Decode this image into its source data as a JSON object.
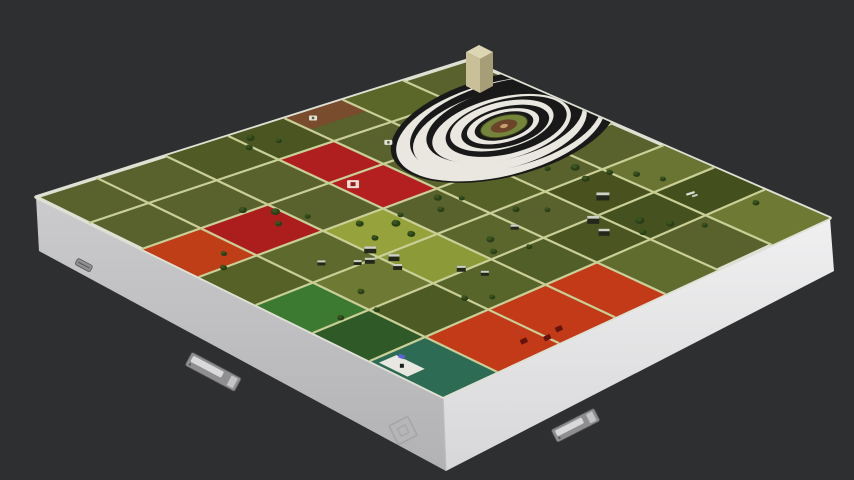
{
  "scene": {
    "background": "#2e2f30",
    "board": {
      "corners": {
        "west": [
          36,
          197
        ],
        "north": [
          468,
          60
        ],
        "east": [
          830,
          218
        ],
        "south": [
          443,
          397
        ]
      },
      "base_color": "#59612c",
      "rim_color": "#dfe0d4",
      "road_color": "#c9cf96",
      "tree_dark": "#2a3f18",
      "tree_light": "#3a541f",
      "building_body": "#23281a",
      "building_roof": "#cfd0c6",
      "u_roads": [
        0.14,
        0.3,
        0.445,
        0.575,
        0.71,
        0.85
      ],
      "v_roads": [
        0.13,
        0.26,
        0.4,
        0.54,
        0.68,
        0.82
      ],
      "parcels": [
        {
          "name": "brown-plot",
          "u": [
            0.575,
            0.71
          ],
          "v": [
            0,
            0.065
          ],
          "color": "#7a4c2e"
        },
        {
          "name": "nw-row-a",
          "u": [
            0.3,
            0.445
          ],
          "v": [
            0,
            0.13
          ],
          "color": "#4f5a24"
        },
        {
          "name": "nw-row-b",
          "u": [
            0.445,
            0.575
          ],
          "v": [
            0,
            0.13
          ],
          "color": "#4a5521"
        },
        {
          "name": "red-upper-a",
          "u": [
            0.445,
            0.575
          ],
          "v": [
            0.13,
            0.26
          ],
          "color": "#b01f1f"
        },
        {
          "name": "red-upper-b",
          "u": [
            0.445,
            0.575
          ],
          "v": [
            0.26,
            0.4
          ],
          "color": "#b3201f"
        },
        {
          "name": "red-left",
          "u": [
            0.14,
            0.3
          ],
          "v": [
            0.26,
            0.4
          ],
          "color": "#ac1e1e"
        },
        {
          "name": "orange-left",
          "u": [
            0,
            0.14
          ],
          "v": [
            0.26,
            0.4
          ],
          "color": "#bf3d17"
        },
        {
          "name": "olive-mid-a",
          "u": [
            0.14,
            0.3
          ],
          "v": [
            0.4,
            0.54
          ],
          "color": "#5e6a2d"
        },
        {
          "name": "lime-a",
          "u": [
            0.3,
            0.445
          ],
          "v": [
            0.4,
            0.54
          ],
          "color": "#96a23c"
        },
        {
          "name": "lime-b",
          "u": [
            0.3,
            0.445
          ],
          "v": [
            0.54,
            0.68
          ],
          "color": "#8c9a38"
        },
        {
          "name": "olive-left-a",
          "u": [
            0,
            0.14
          ],
          "v": [
            0.4,
            0.54
          ],
          "color": "#556127"
        },
        {
          "name": "green-bright",
          "u": [
            0,
            0.14
          ],
          "v": [
            0.54,
            0.68
          ],
          "color": "#3c7a31"
        },
        {
          "name": "green-deep",
          "u": [
            0,
            0.14
          ],
          "v": [
            0.68,
            0.82
          ],
          "color": "#2f5a27"
        },
        {
          "name": "teal-plot",
          "u": [
            0,
            0.14
          ],
          "v": [
            0.82,
            1
          ],
          "color": "#2e6b55"
        },
        {
          "name": "orange-big",
          "u": [
            0.14,
            0.575
          ],
          "v": [
            0.82,
            1
          ],
          "color": "#c23a17"
        },
        {
          "name": "olive-dark-a",
          "u": [
            0.71,
            0.85
          ],
          "v": [
            0.54,
            0.68
          ],
          "color": "#49511f"
        },
        {
          "name": "olive-dark-b",
          "u": [
            0.85,
            1
          ],
          "v": [
            0.68,
            0.82
          ],
          "color": "#43501d"
        },
        {
          "name": "olive-dark-c",
          "u": [
            0.575,
            0.71
          ],
          "v": [
            0.68,
            0.82
          ],
          "color": "#4a5522"
        },
        {
          "name": "olive-light-a",
          "u": [
            0.85,
            1
          ],
          "v": [
            0.82,
            1
          ],
          "color": "#6e7a33"
        },
        {
          "name": "olive-light-b",
          "u": [
            0.85,
            1
          ],
          "v": [
            0.54,
            0.68
          ],
          "color": "#6a7533"
        },
        {
          "name": "olive-mid-b",
          "u": [
            0.575,
            0.71
          ],
          "v": [
            0.4,
            0.54
          ],
          "color": "#566128"
        },
        {
          "name": "olive-mid-c",
          "u": [
            0.445,
            0.575
          ],
          "v": [
            0.54,
            0.68
          ],
          "color": "#5a662c"
        },
        {
          "name": "olive-mid-d",
          "u": [
            0.575,
            0.71
          ],
          "v": [
            0.82,
            1
          ],
          "color": "#5f6c2e"
        },
        {
          "name": "olive-dark-d",
          "u": [
            0.71,
            0.85
          ],
          "v": [
            0.68,
            0.82
          ],
          "color": "#45511f"
        },
        {
          "name": "olive-mid-e",
          "u": [
            0.71,
            0.85
          ],
          "v": [
            0,
            0.13
          ],
          "color": "#5b6629"
        },
        {
          "name": "lime-c",
          "u": [
            0.14,
            0.3
          ],
          "v": [
            0.54,
            0.68
          ],
          "color": "#6e7a33"
        },
        {
          "name": "mid-f",
          "u": [
            0.3,
            0.445
          ],
          "v": [
            0.68,
            0.82
          ],
          "color": "#57642a"
        },
        {
          "name": "mid-g",
          "u": [
            0.445,
            0.575
          ],
          "v": [
            0.68,
            0.82
          ],
          "color": "#525e27"
        },
        {
          "name": "mid-h",
          "u": [
            0.14,
            0.3
          ],
          "v": [
            0.68,
            0.82
          ],
          "color": "#4e5a24"
        }
      ],
      "trees": [
        [
          0.47,
          0.03,
          4
        ],
        [
          0.44,
          0.06,
          3.5
        ],
        [
          0.5,
          0.07,
          3
        ],
        [
          0.25,
          0.25,
          4
        ],
        [
          0.29,
          0.29,
          4.5
        ],
        [
          0.26,
          0.33,
          3.5
        ],
        [
          0.32,
          0.34,
          3
        ],
        [
          0.37,
          0.42,
          4
        ],
        [
          0.42,
          0.46,
          4.5
        ],
        [
          0.35,
          0.48,
          3.5
        ],
        [
          0.41,
          0.51,
          4
        ],
        [
          0.45,
          0.44,
          3
        ],
        [
          0.55,
          0.43,
          4
        ],
        [
          0.52,
          0.47,
          3.5
        ],
        [
          0.58,
          0.46,
          3
        ],
        [
          0.82,
          0.5,
          4.5
        ],
        [
          0.8,
          0.55,
          4
        ],
        [
          0.85,
          0.56,
          3.5
        ],
        [
          0.78,
          0.47,
          3
        ],
        [
          0.75,
          0.75,
          4.5
        ],
        [
          0.78,
          0.8,
          4
        ],
        [
          0.72,
          0.79,
          3.5
        ],
        [
          0.82,
          0.85,
          3
        ],
        [
          0.95,
          0.85,
          3.5
        ],
        [
          0.5,
          0.62,
          4
        ],
        [
          0.47,
          0.66,
          3.5
        ],
        [
          0.53,
          0.69,
          3
        ],
        [
          0.18,
          0.62,
          3.5
        ],
        [
          0.15,
          0.69,
          3
        ],
        [
          0.08,
          0.67,
          3.5
        ],
        [
          0.3,
          0.76,
          3.5
        ],
        [
          0.34,
          0.79,
          3
        ],
        [
          0.06,
          0.4,
          3.5
        ],
        [
          0.1,
          0.36,
          3
        ],
        [
          0.62,
          0.56,
          3.5
        ],
        [
          0.66,
          0.6,
          3
        ],
        [
          0.88,
          0.6,
          3.5
        ],
        [
          0.9,
          0.65,
          3
        ]
      ],
      "buildings": [
        [
          0.76,
          0.64,
          13,
          8
        ],
        [
          0.68,
          0.7,
          12,
          8
        ],
        [
          0.66,
          0.75,
          11,
          7
        ],
        [
          0.3,
          0.52,
          12,
          7
        ],
        [
          0.27,
          0.55,
          10,
          6
        ],
        [
          0.31,
          0.57,
          11,
          7
        ],
        [
          0.25,
          0.54,
          8,
          5
        ],
        [
          0.29,
          0.6,
          9,
          6
        ],
        [
          0.2,
          0.5,
          8,
          5
        ],
        [
          0.37,
          0.68,
          9,
          6
        ],
        [
          0.39,
          0.72,
          8,
          5
        ],
        [
          0.56,
          0.62,
          8,
          5
        ]
      ],
      "markers": [
        {
          "type": "white-mark",
          "u": 0.615,
          "v": 0.03
        },
        {
          "type": "white-mark",
          "u": 0.645,
          "v": 0.195
        },
        {
          "type": "red-tile-icon",
          "u": 0.475,
          "v": 0.29
        },
        {
          "type": "white-squiggle",
          "u": 0.895,
          "v": 0.735
        },
        {
          "type": "white-tile",
          "u": 0.03,
          "v": 0.87
        },
        {
          "type": "blue-bit",
          "u": 0.055,
          "v": 0.845
        },
        {
          "type": "piece-dark-red",
          "u": 0.3,
          "v": 0.97
        },
        {
          "type": "piece-dark-red",
          "u": 0.26,
          "v": 0.95
        },
        {
          "type": "piece-dark-red",
          "u": 0.34,
          "v": 0.96
        }
      ]
    },
    "hill": {
      "cx": 504,
      "cy": 126,
      "rot": -14,
      "ratio": 0.44,
      "stripe_colors": [
        "#191919",
        "#e9e7e0"
      ],
      "rings": [
        {
          "rx": 116,
          "dx": 0,
          "dy": 0
        },
        {
          "rx": 107,
          "dx": -4,
          "dy": 2
        },
        {
          "rx": 98,
          "dx": 2,
          "dy": -1
        },
        {
          "rx": 89,
          "dx": -5,
          "dy": 3
        },
        {
          "rx": 80,
          "dx": 1,
          "dy": -2
        },
        {
          "rx": 71,
          "dx": -3,
          "dy": 2
        },
        {
          "rx": 62,
          "dx": 2,
          "dy": 1
        },
        {
          "rx": 53,
          "dx": -2,
          "dy": -1
        },
        {
          "rx": 45,
          "dx": 1,
          "dy": 1
        },
        {
          "rx": 37,
          "dx": -1,
          "dy": 0
        },
        {
          "rx": 30,
          "dx": 0,
          "dy": 0
        }
      ],
      "core": [
        {
          "rx": 24,
          "ry": 10.5,
          "fill": "#74843a",
          "stroke": "#384018"
        },
        {
          "rx": 13.5,
          "ry": 6,
          "fill": "#6b4429"
        },
        {
          "rx": 4,
          "ry": 2,
          "fill": "#c79c6f"
        }
      ]
    },
    "tower": {
      "faces": [
        {
          "name": "front",
          "points": [
            [
              466,
              52
            ],
            [
              466,
              86
            ],
            [
              480,
              93
            ],
            [
              480,
              59
            ]
          ],
          "color": "#c9c09a"
        },
        {
          "name": "side",
          "points": [
            [
              480,
              59
            ],
            [
              480,
              93
            ],
            [
              493,
              86
            ],
            [
              493,
              52
            ]
          ],
          "color": "#a79d76"
        },
        {
          "name": "top",
          "points": [
            [
              466,
              52
            ],
            [
              479,
              45
            ],
            [
              493,
              52
            ],
            [
              480,
              59
            ]
          ],
          "color": "#ddd6b2"
        }
      ]
    },
    "case": {
      "left_face": {
        "points": [
          [
            36,
            197
          ],
          [
            443,
            397
          ],
          [
            446,
            471
          ],
          [
            39,
            251
          ]
        ],
        "top": "#cbcbcd",
        "bottom": "#b2b2b4"
      },
      "right_face": {
        "points": [
          [
            443,
            397
          ],
          [
            830,
            218
          ],
          [
            834,
            271
          ],
          [
            446,
            471
          ]
        ],
        "top": "#f0f0f1",
        "bottom": "#d7d7d9"
      },
      "seam": [
        [
          443,
          397
        ],
        [
          446,
          471
        ]
      ],
      "seam_color": "#bdbdbf",
      "latches": [
        {
          "name": "latch-front-left",
          "x": 192,
          "y": 352,
          "rot": 28,
          "w": 56,
          "h": 15
        },
        {
          "name": "latch-front-right",
          "x": 551,
          "y": 430,
          "rot": -27,
          "w": 48,
          "h": 14
        },
        {
          "name": "hinge-front-left",
          "x": 78,
          "y": 258,
          "rot": 28,
          "w": 17,
          "h": 7,
          "hinge": true
        }
      ],
      "latch_colors": {
        "plate": "#8f8f92",
        "edge": "#56565a",
        "lever": "#d9d9db",
        "knob": "#c4c4c6"
      },
      "logo": {
        "x": 389,
        "y": 426,
        "rot": -27,
        "size": 21,
        "color": "#a5a5a7"
      }
    }
  }
}
